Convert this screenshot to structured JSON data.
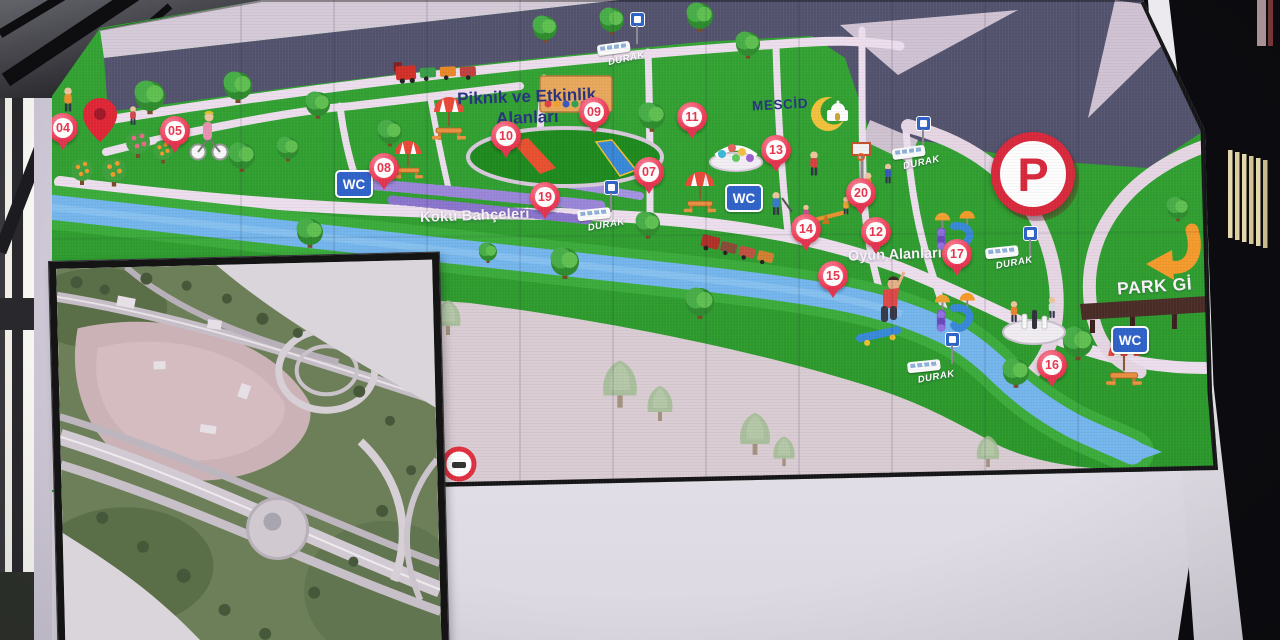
{
  "scene": {
    "description": "Photo of a large outdoor LED information screen displaying an illustrated park map with numbered points of interest, plus an aerial-photo inset panel at lower left",
    "colors": {
      "map_green": "#2f9f2f",
      "road_gray_blue": "#53536e",
      "path_pink": "#ecdeec",
      "river_blue": "#74b5ec",
      "open_area_pink": "#d9ccd3",
      "marker_red": "#ee3b55",
      "sign_blue": "#2f62c8",
      "umbrella_red": "#e84838",
      "arrow_orange": "#f49a2c",
      "parking_red": "#d8283c",
      "label_navy": "#27337f",
      "label_white": "#f7f3f7"
    }
  },
  "map": {
    "labels": {
      "picnic_line1": "Piknik ve Etkinlik",
      "picnic_line2": "Alanları",
      "scent_gardens": "Koku Bahçeleri",
      "play_areas": "Oyun Alanları",
      "mosque": "MESCİD",
      "park_entrance": "PARK Gİ",
      "parking_letter": "P"
    },
    "markers": [
      {
        "num": "04",
        "x": 63,
        "y": 130
      },
      {
        "num": "05",
        "x": 175,
        "y": 133
      },
      {
        "num": "07",
        "x": 649,
        "y": 174
      },
      {
        "num": "08",
        "x": 384,
        "y": 170
      },
      {
        "num": "09",
        "x": 594,
        "y": 114
      },
      {
        "num": "10",
        "x": 506,
        "y": 138
      },
      {
        "num": "11",
        "x": 692,
        "y": 119
      },
      {
        "num": "12",
        "x": 876,
        "y": 234
      },
      {
        "num": "13",
        "x": 776,
        "y": 152
      },
      {
        "num": "14",
        "x": 806,
        "y": 231
      },
      {
        "num": "15",
        "x": 833,
        "y": 278
      },
      {
        "num": "16",
        "x": 1052,
        "y": 367
      },
      {
        "num": "17",
        "x": 957,
        "y": 256
      },
      {
        "num": "19",
        "x": 545,
        "y": 199
      },
      {
        "num": "20",
        "x": 861,
        "y": 195
      }
    ],
    "bus_stops": [
      {
        "label": "DURAK",
        "x": 598,
        "y": 42,
        "rot": -8
      },
      {
        "label": "DURAK",
        "x": 893,
        "y": 146,
        "rot": -8
      },
      {
        "label": "DURAK",
        "x": 578,
        "y": 208,
        "rot": -6
      },
      {
        "label": "DURAK",
        "x": 986,
        "y": 246,
        "rot": -6
      },
      {
        "label": "DURAK",
        "x": 908,
        "y": 360,
        "rot": -6
      }
    ],
    "wc_signs": [
      {
        "label": "WC",
        "x": 335,
        "y": 170
      },
      {
        "label": "WC",
        "x": 725,
        "y": 184
      },
      {
        "label": "WC",
        "x": 1111,
        "y": 326
      }
    ],
    "stop_sign_posts": [
      {
        "x": 630,
        "y": 12
      },
      {
        "x": 916,
        "y": 116
      },
      {
        "x": 604,
        "y": 180
      },
      {
        "x": 1023,
        "y": 226
      },
      {
        "x": 945,
        "y": 332
      }
    ]
  }
}
